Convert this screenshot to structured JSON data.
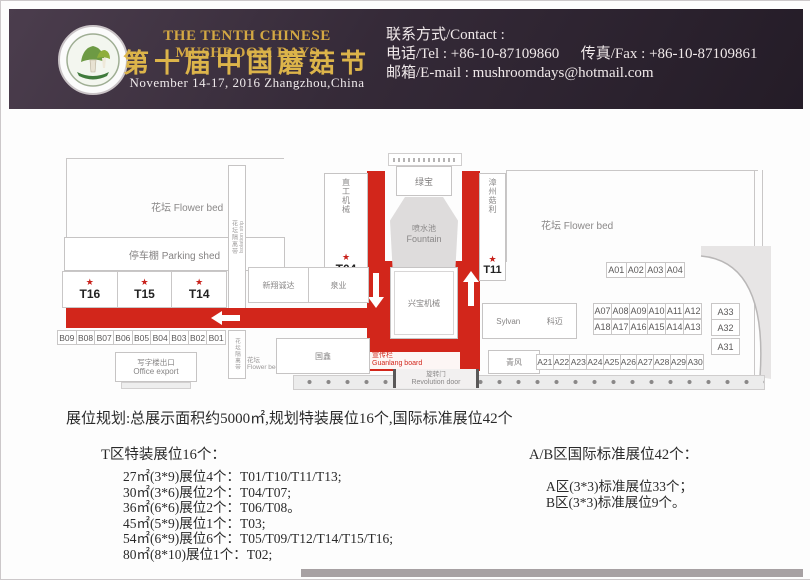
{
  "header": {
    "title_en": "THE TENTH CHINESE MUSHROOM DAYS",
    "title_zh": "第十届中国蘑菇节",
    "date_line": "November 14-17, 2016  Zhangzhou,China",
    "contact": {
      "label": "联系方式/Contact :",
      "tel": "电话/Tel : +86-10-87109860",
      "fax": "传真/Fax : +86-10-87109861",
      "email": "邮箱/E-mail : mushroomdays@hotmail.com"
    },
    "colors": {
      "background": "#342939",
      "gold": "#d3a843",
      "accent_red": "#d2261b"
    }
  },
  "glyphs": {
    "star": "★"
  },
  "map": {
    "flower_bed_left": "花坛  Flower bed",
    "parking_shed": "停车棚  Parking shed",
    "isolation_zh": "花坛隔离带",
    "isolation_en": "Isolation strip",
    "t_left": [
      "T16",
      "T15",
      "T14"
    ],
    "b_row": [
      "B09",
      "B08",
      "B07",
      "B06",
      "B05",
      "B04",
      "B03",
      "B02",
      "B01"
    ],
    "office_export_zh": "写字楼出口",
    "office_export_en": "Office export",
    "machinery_left": "直工机械",
    "t04": "T04",
    "lvbao": "绿宝",
    "fountain_zh": "喷水池",
    "fountain_en": "Fountain",
    "xingbao": "兴宝机械",
    "board_zh": "宣传栏",
    "board_en": "Guanlang board",
    "door_zh": "旋转门",
    "door_en": "Revolution door",
    "zhangzhou_guli": "漳州菇利",
    "t11": "T11",
    "flower_bed_right": "花坛  Flower bed",
    "flower_bed_small_zh": "花坛",
    "flower_bed_small_en": "Flower bed",
    "xinxiang": "新翔诚达",
    "quanye": "泉业",
    "guoxin": "国鑫",
    "sylvan": "Sylvan",
    "kemai": "科迈",
    "qingfeng": "青风",
    "a_row1": [
      "A01",
      "A02",
      "A03",
      "A04"
    ],
    "a_row2": [
      "A07",
      "A08",
      "A09",
      "A10",
      "A11",
      "A12"
    ],
    "a_row3": [
      "A18",
      "A17",
      "A16",
      "A15",
      "A14",
      "A13"
    ],
    "a_col": [
      "A33",
      "A32",
      "A31"
    ],
    "a_row4": [
      "A21",
      "A22",
      "A23",
      "A24",
      "A25",
      "A26",
      "A27",
      "A28",
      "A29",
      "A30"
    ]
  },
  "summary": {
    "overview": "展位规划:总展示面积约5000㎡,规划特装展位16个,国际标准展位42个",
    "t_section": {
      "header": "T区特装展位16个：",
      "items": [
        "27㎡(3*9)展位4个：T01/T10/T11/T13;",
        "30㎡(3*6)展位2个：T04/T07;",
        "36㎡(6*6)展位2个：T06/T08。",
        "45㎡(5*9)展位1个：T03;",
        "54㎡(6*9)展位6个：T05/T09/T12/T14/T15/T16;",
        "80㎡(8*10)展位1个：T02;"
      ]
    },
    "ab_section": {
      "header": "A/B区国际标准展位42个：",
      "items": [
        "A区(3*3)标准展位33个；",
        "B区(3*3)标准展位9个。"
      ]
    }
  }
}
